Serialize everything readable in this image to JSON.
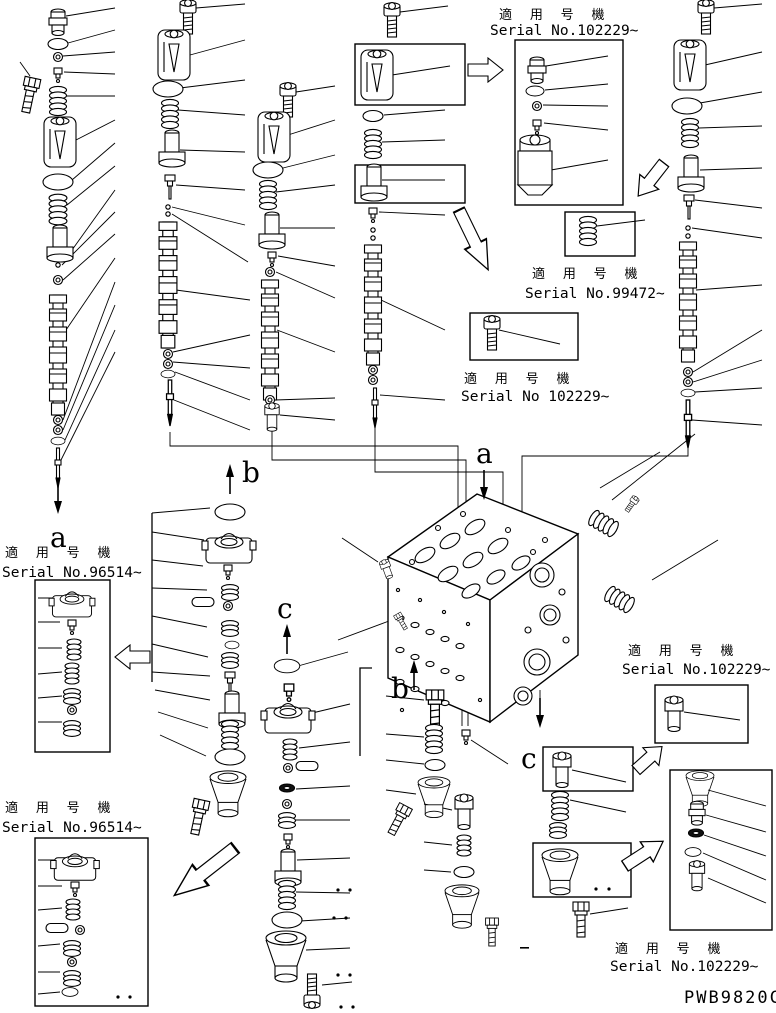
{
  "colors": {
    "background": "#ffffff",
    "line": "#000000"
  },
  "part_code": "PWB9820C",
  "serial_labels": {
    "top_right": {
      "jp": "適 用 号 機",
      "serial": "Serial No.102229~"
    },
    "right_upper": {
      "jp": "適 用 号 機",
      "serial": "Serial No.99472~"
    },
    "center": {
      "jp": "適 用 号 機",
      "serial": "Serial No 102229~"
    },
    "left_middle": {
      "jp": "適 用 号 機",
      "serial": "Serial No.96514~"
    },
    "left_bottom": {
      "jp": "適 用 号 機",
      "serial": "Serial No.96514~"
    },
    "right_middle": {
      "jp": "適 用 号 機",
      "serial": "Serial No.102229~"
    },
    "right_bottom": {
      "jp": "適 用 号 機",
      "serial": "Serial No.102229~"
    }
  },
  "section_markers": {
    "a1": "a",
    "b1": "b",
    "c1": "c",
    "a2": "a",
    "b2": "b",
    "c2": "c"
  }
}
